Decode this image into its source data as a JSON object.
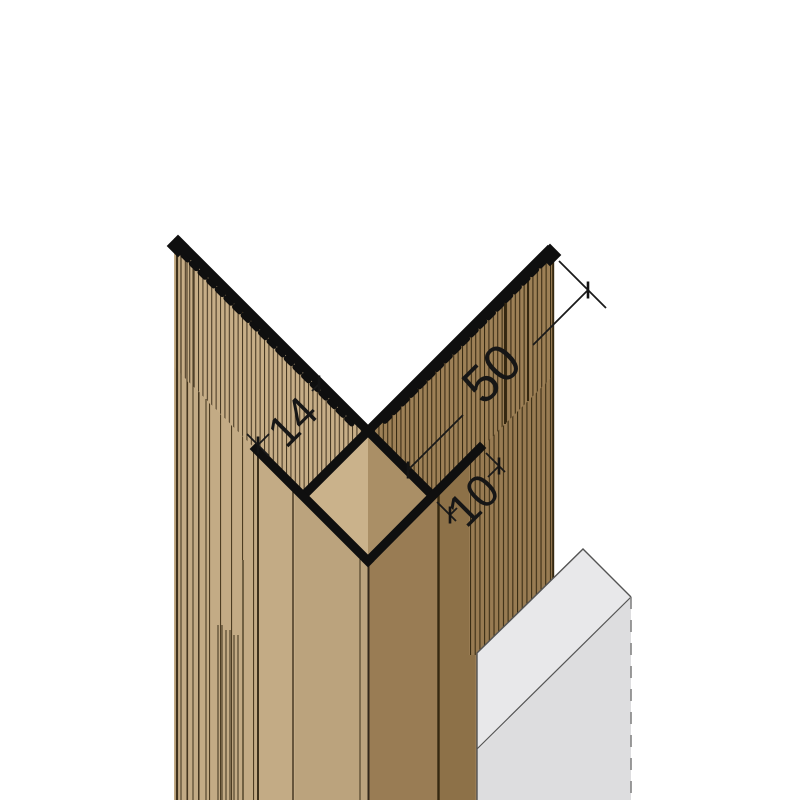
{
  "drawing": {
    "title": "corner-profile-technical-drawing",
    "dimensions": {
      "flange_length": "50",
      "panel_thickness": "14",
      "return_leg": "10"
    },
    "colors": {
      "background": "#ffffff",
      "profile_black": "#0f0f0f",
      "dimension_ink": "#1a1a1a",
      "left_panel_base": "#c3ab85",
      "left_panel_band_dark": "#bba37d",
      "right_panel_base": "#997c54",
      "right_panel_band_dark": "#8d7148",
      "diamond_left": "#cab28b",
      "diamond_right": "#aa8f66",
      "block_top": "#e8e8ea",
      "block_front": "#dddddf",
      "block_outline": "#545454"
    }
  }
}
